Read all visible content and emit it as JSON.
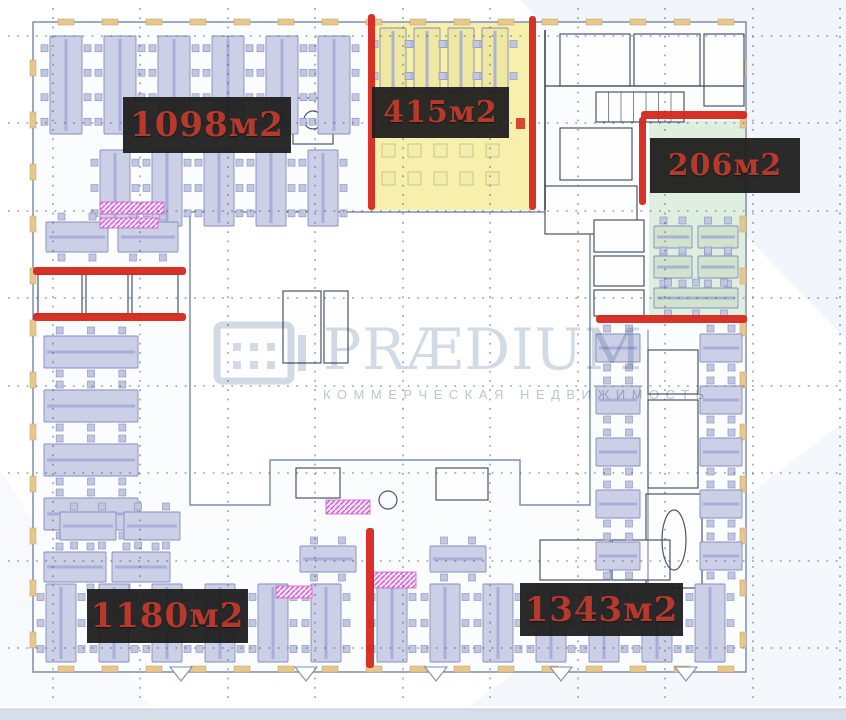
{
  "page": {
    "type": "office-floor-plan"
  },
  "areas": [
    {
      "id": "1098",
      "label": "1098м2"
    },
    {
      "id": "415",
      "label": "415м2"
    },
    {
      "id": "206",
      "label": "206м2"
    },
    {
      "id": "1180",
      "label": "1180м2"
    },
    {
      "id": "1343",
      "label": "1343м2"
    }
  ],
  "watermark": {
    "brand": "PRÆDIUM",
    "tagline": "КОММЕРЧЕСКАЯ НЕДВИЖИМОСТЬ"
  },
  "colors": {
    "accent_red": "#d7271c",
    "label_bg": "rgba(30,29,29,0.94)",
    "label_text": "#b5392d",
    "zone_yellow": "#f6efa5",
    "zone_green": "#ddeedd",
    "desk_fill": "#ccd0e6",
    "desk_yellow": "#efe8a2",
    "desk_green": "#cfe3cf",
    "chair_fill": "#c2c7e0",
    "desk_stroke": "#878dbe",
    "wall": "#7e8dac",
    "room_stroke": "#4a5568",
    "sill": "#e6c88f",
    "magenta": "#cf5ecf",
    "grid_dot": "#4a4f57",
    "watermark_blue": "#ccd6e2",
    "footer_strip": "#d8dee9",
    "bg_tint": "#edf2f9"
  }
}
